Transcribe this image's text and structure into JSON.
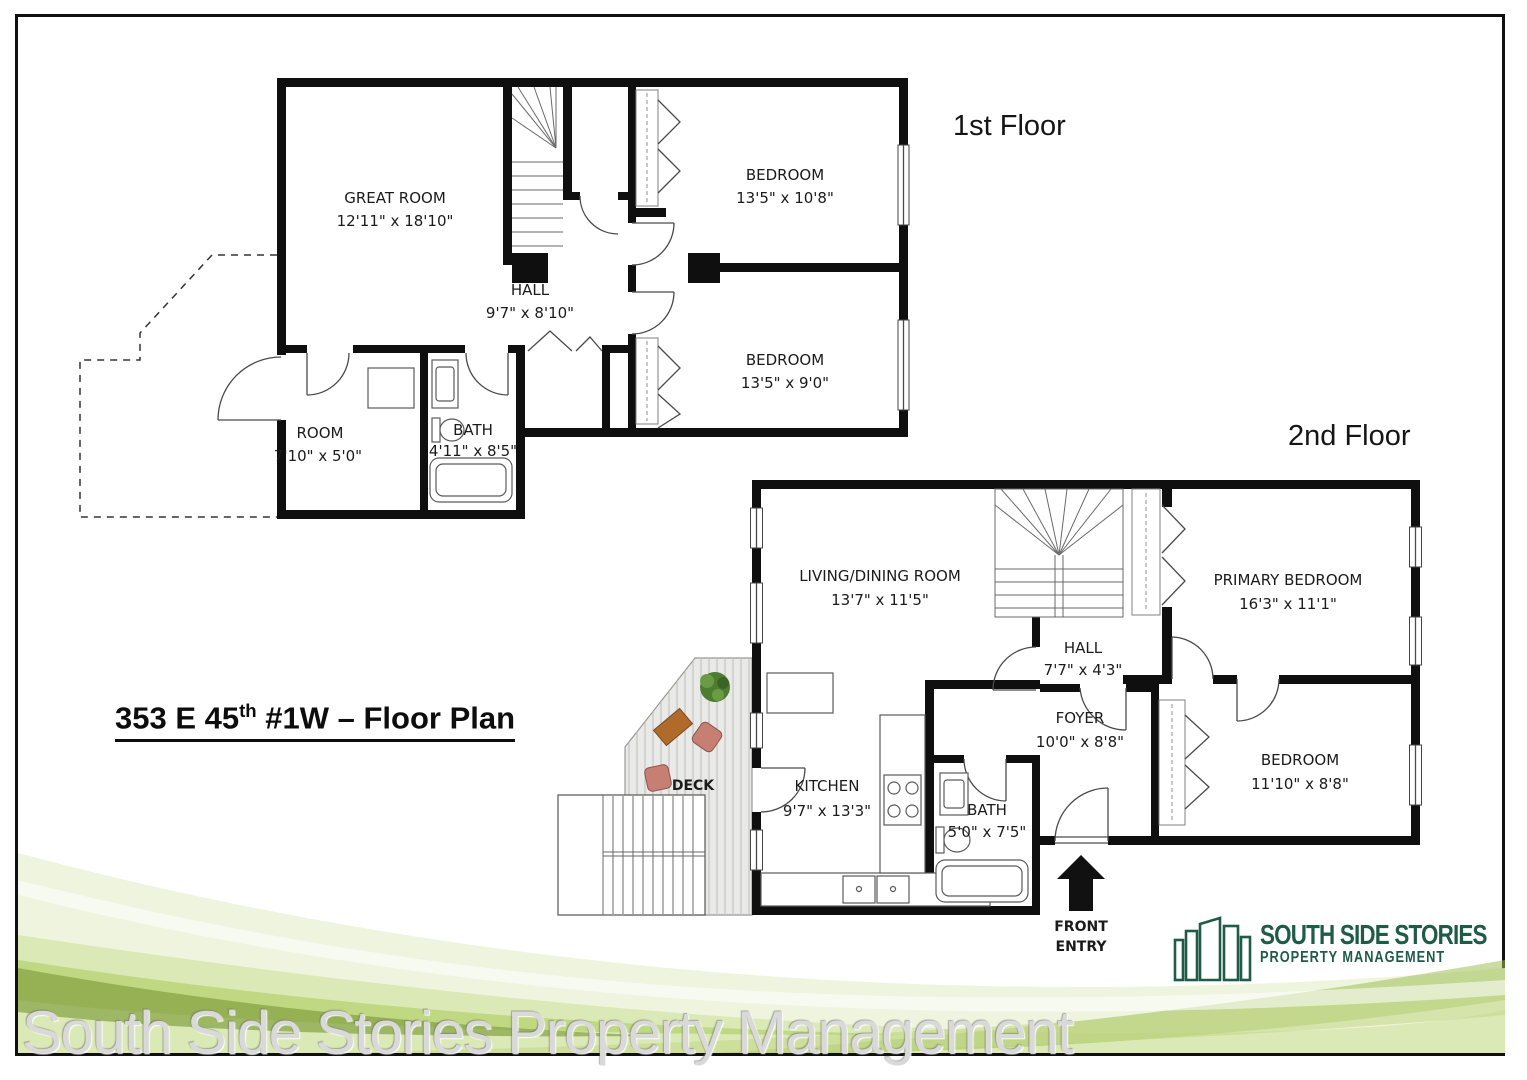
{
  "title": {
    "prefix": "353 E 45",
    "sup": "th",
    "suffix": " #1W – Floor Plan"
  },
  "header": {
    "floor1_label": "1st Floor",
    "floor2_label": "2nd Floor"
  },
  "floor1": {
    "rooms": {
      "great_room": {
        "name": "GREAT ROOM",
        "dims": "12'11\" x 18'10\""
      },
      "hall": {
        "name": "HALL",
        "dims": "9'7\" x 8'10\""
      },
      "bedroom1": {
        "name": "BEDROOM",
        "dims": "13'5\" x 10'8\""
      },
      "bedroom2": {
        "name": "BEDROOM",
        "dims": "13'5\" x 9'0\""
      },
      "room": {
        "name": "ROOM",
        "dims": "7'10\" x 5'0\""
      },
      "bath": {
        "name": "BATH",
        "dims": "4'11\" x 8'5\""
      }
    }
  },
  "floor2": {
    "rooms": {
      "living": {
        "name": "LIVING/DINING ROOM",
        "dims": "13'7\" x 11'5\""
      },
      "primary": {
        "name": "PRIMARY BEDROOM",
        "dims": "16'3\" x 11'1\""
      },
      "hall": {
        "name": "HALL",
        "dims": "7'7\" x 4'3\""
      },
      "foyer": {
        "name": "FOYER",
        "dims": "10'0\" x 8'8\""
      },
      "bedroom": {
        "name": "BEDROOM",
        "dims": "11'10\" x 8'8\""
      },
      "kitchen": {
        "name": "KITCHEN",
        "dims": "9'7\" x 13'3\""
      },
      "bath": {
        "name": "BATH",
        "dims": "5'0\" x 7'5\""
      }
    },
    "deck_label": "DECK",
    "front_entry": {
      "line1": "FRONT",
      "line2": "ENTRY"
    }
  },
  "logo": {
    "name": "SOUTH SIDE STORIES",
    "tagline": "PROPERTY MANAGEMENT",
    "color": "#1f5b46"
  },
  "watermark": "South Side Stories Property Management",
  "colors": {
    "wall": "#0f0f0f",
    "logo_green": "#1f5b46",
    "wave_green": "#a6c85e",
    "watermark_gray": "#d9d9d9"
  }
}
